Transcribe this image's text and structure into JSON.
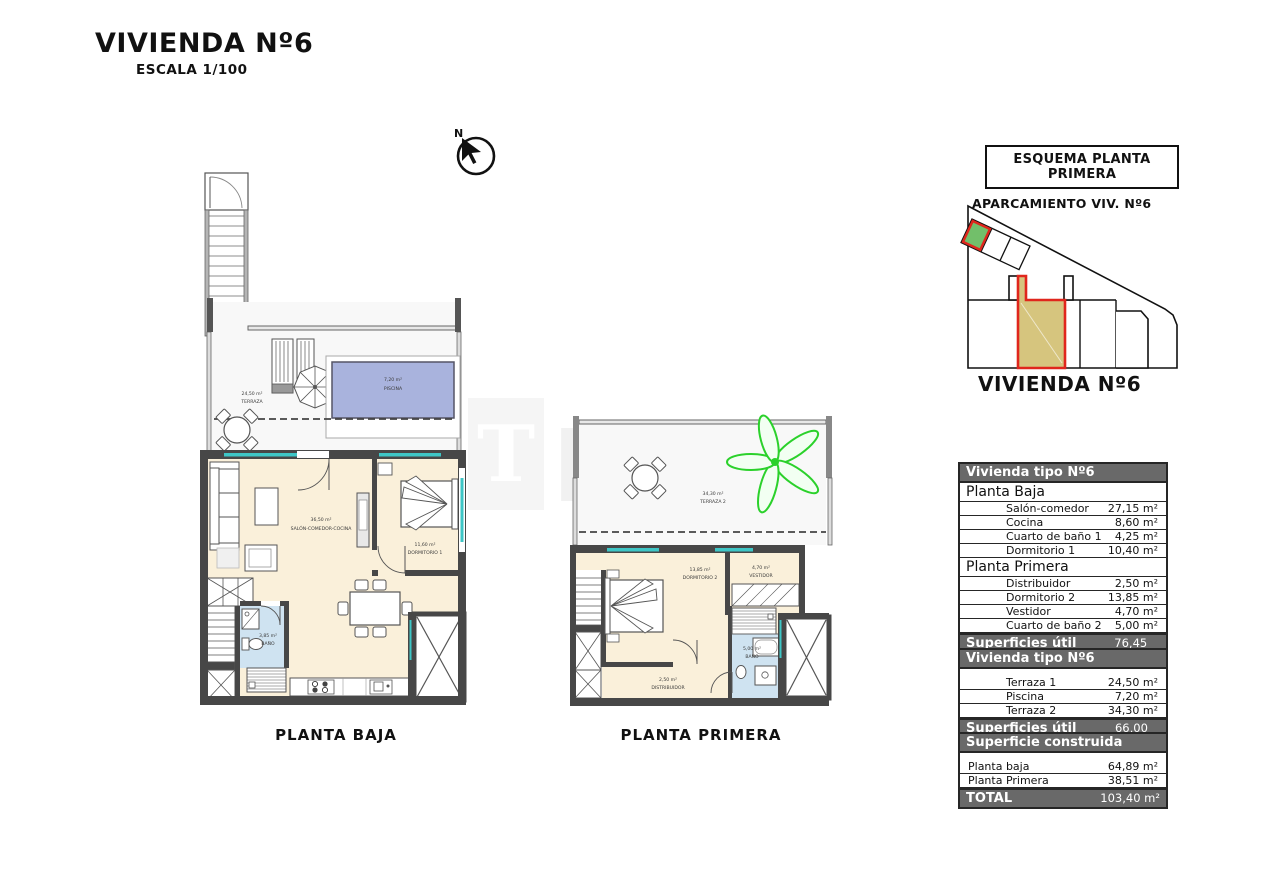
{
  "title": "VIVIENDA Nº6",
  "scale": "ESCALA 1/100",
  "north_label": "N",
  "watermark": {
    "logo": "T",
    "text": "EKC"
  },
  "colors": {
    "wall": "#474747",
    "room_cream": "#faf0da",
    "bath_blue": "#cfe3f1",
    "pool_blue": "#a9b3dd",
    "accent_teal": "#3ec6c6",
    "highlight_red": "#e0261c",
    "parking_green": "#72bf6a",
    "unit_tan": "#d6c57e",
    "bar_gray": "#696969",
    "palm_green": "#2bd12b"
  },
  "planta_baja": {
    "caption": "PLANTA BAJA",
    "terraza": {
      "area": "24,50 m²",
      "name": "TERRAZA"
    },
    "piscina": {
      "area": "7,20 m²",
      "name": "PISCINA"
    },
    "salon": {
      "area": "36,50 m²",
      "name": "SALÓN-COMEDOR-COCINA"
    },
    "dormitorio1": {
      "area": "11,60 m²",
      "name": "DORMITORIO 1"
    },
    "bano": {
      "area": "3,85 m²",
      "name": "BAÑO"
    }
  },
  "planta_primera": {
    "caption": "PLANTA PRIMERA",
    "terraza2": {
      "area": "34,30 m²",
      "name": "TERRAZA 2"
    },
    "dormitorio2": {
      "area": "13,85 m²",
      "name": "DORMITORIO 2"
    },
    "vestidor": {
      "area": "4,70 m²",
      "name": "VESTIDOR"
    },
    "bano2": {
      "area": "5,00 m²",
      "name": "BAÑO"
    },
    "distribuidor": {
      "area": "2,50 m²",
      "name": "DISTRIBUIDOR"
    }
  },
  "esquema": {
    "box_title": "ESQUEMA PLANTA PRIMERA",
    "parking_label": "APARCAMIENTO VIV. Nº6",
    "vivienda_label": "VIVIENDA Nº6"
  },
  "tables": {
    "interior": {
      "header": "Vivienda tipo Nº6",
      "sections": [
        {
          "title": "Planta Baja",
          "rows": [
            {
              "label": "Salón-comedor",
              "value": "27,15 m²"
            },
            {
              "label": "Cocina",
              "value": "8,60 m²"
            },
            {
              "label": "Cuarto de baño 1",
              "value": "4,25 m²"
            },
            {
              "label": "Dormitorio 1",
              "value": "10,40 m²"
            }
          ]
        },
        {
          "title": "Planta Primera",
          "rows": [
            {
              "label": "Distribuidor",
              "value": "2,50 m²"
            },
            {
              "label": "Dormitorio 2",
              "value": "13,85 m²"
            },
            {
              "label": "Vestidor",
              "value": "4,70 m²"
            },
            {
              "label": "Cuarto de baño 2",
              "value": "5,00 m²"
            }
          ]
        }
      ],
      "footer": {
        "label": "Superficies útil interior",
        "value": "76,45 m²"
      }
    },
    "exterior": {
      "header": "Vivienda tipo Nº6",
      "rows": [
        {
          "label": "Terraza 1",
          "value": "24,50 m²"
        },
        {
          "label": "Piscina",
          "value": "7,20 m²"
        },
        {
          "label": "Terraza 2",
          "value": "34,30 m²"
        }
      ],
      "footer": {
        "label": "Superficies útil exterior",
        "value": "66,00 m²"
      }
    },
    "construida": {
      "header": "Superficie construida",
      "rows": [
        {
          "label": "Planta baja",
          "value": "64,89 m²"
        },
        {
          "label": "Planta Primera",
          "value": "38,51 m²"
        }
      ],
      "footer": {
        "label": "TOTAL",
        "value": "103,40 m²"
      }
    }
  }
}
